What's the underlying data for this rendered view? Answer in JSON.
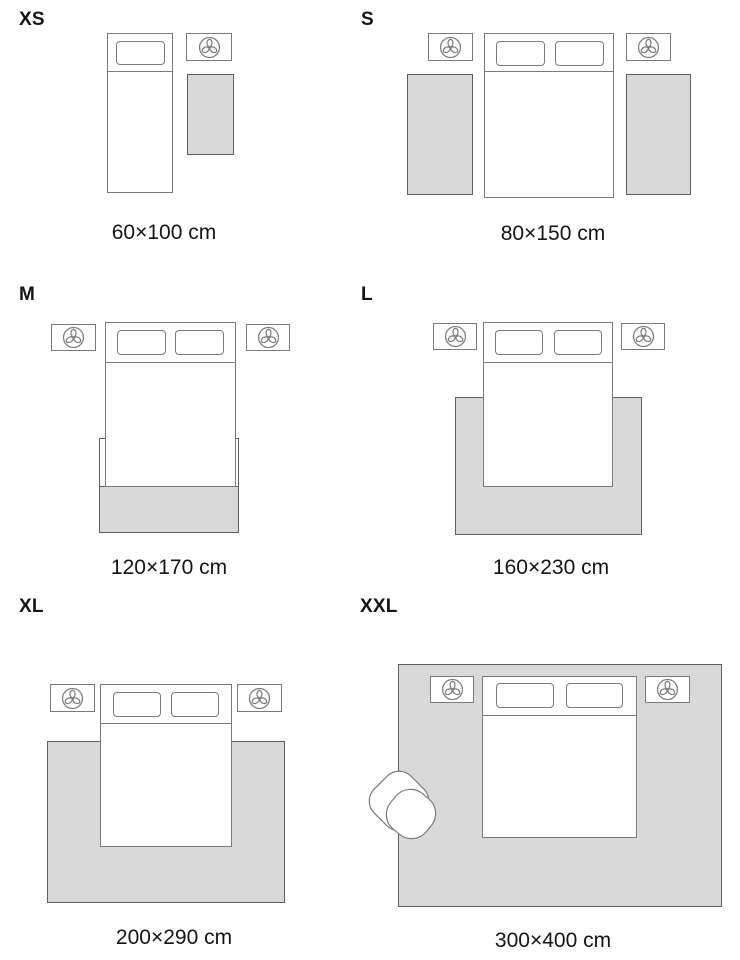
{
  "guide": {
    "unit": "cm",
    "sections": [
      {
        "id": "xs",
        "label": "XS",
        "dimensions": "60×100 cm",
        "scene": "single bed, one nightstand, rug beside bed"
      },
      {
        "id": "s",
        "label": "S",
        "dimensions": "80×150 cm",
        "scene": "double bed, two nightstands, runner rug each side"
      },
      {
        "id": "m",
        "label": "M",
        "dimensions": "120×170 cm",
        "scene": "double bed, two nightstands, rug at foot of bed"
      },
      {
        "id": "l",
        "label": "L",
        "dimensions": "160×230 cm",
        "scene": "double bed, two nightstands, rug under lower half of bed"
      },
      {
        "id": "xl",
        "label": "XL",
        "dimensions": "200×290 cm",
        "scene": "double bed, two nightstands, large rug under bed"
      },
      {
        "id": "xxl",
        "label": "XXL",
        "dimensions": "300×400 cm",
        "scene": "room-size rug under bed, nightstands and armchair"
      }
    ]
  },
  "icons": {
    "nightstand": "plant-icon",
    "seat": "armchair"
  },
  "colors": {
    "background": "#ffffff",
    "rug_fill": "#d9d9d9",
    "rug_outline": "#5f5f5f",
    "furniture_outline": "#7b7b7b",
    "text": "#151515"
  }
}
